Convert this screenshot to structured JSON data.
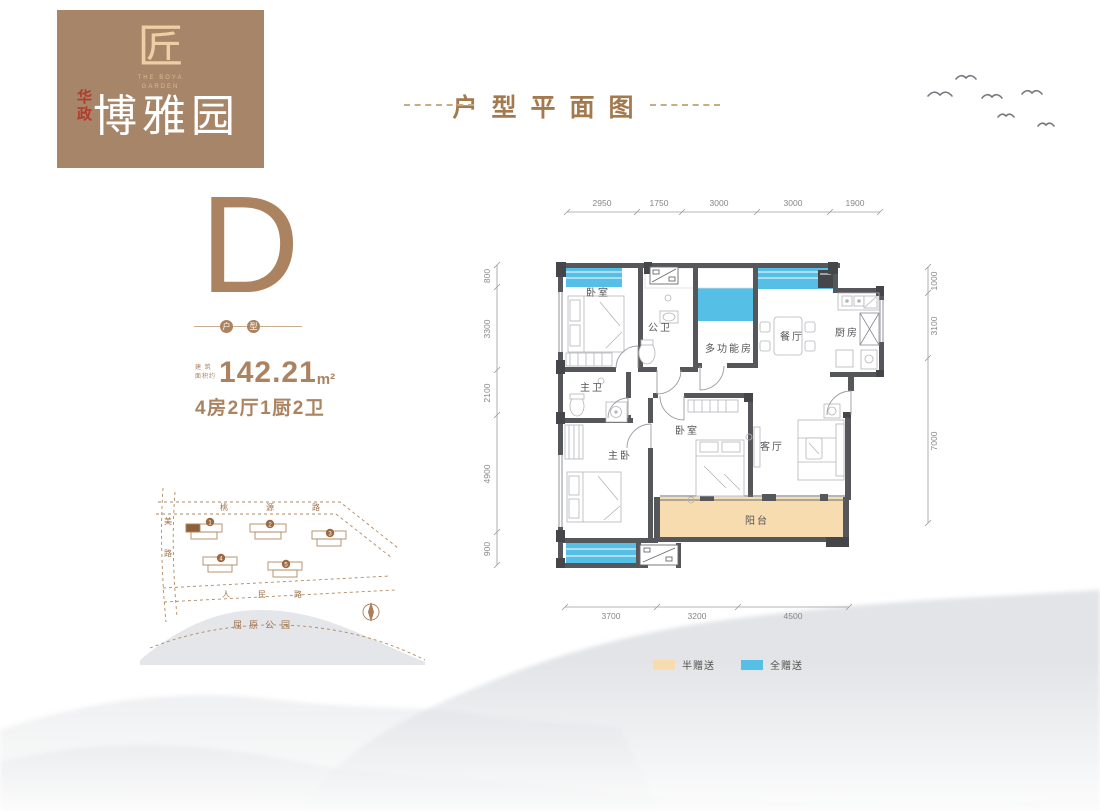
{
  "logo": {
    "seal_glyph": "匠",
    "brand_en_line1": "THE BOYA",
    "brand_en_line2": "GARDEN",
    "brand_prefix": "华政",
    "brand_name": "博雅园"
  },
  "header": {
    "title": "户型平面图"
  },
  "unit": {
    "letter": "D",
    "badge_left": "户",
    "badge_right": "型",
    "area_prefix_top": "建 筑",
    "area_prefix_bottom": "面积约",
    "area_value": "142.21",
    "area_unit": "m²",
    "layout": "4房2厅1厨2卫"
  },
  "floorplan": {
    "rooms": {
      "bedroom_tl": "卧室",
      "public_bath": "公卫",
      "multi_room": "多功能房",
      "dining": "餐厅",
      "kitchen": "厨房",
      "master_bath": "主卫",
      "master_bedroom": "主卧",
      "bedroom_mid": "卧室",
      "living": "客厅",
      "balcony": "阳台"
    },
    "dim_top": [
      "2950",
      "1750",
      "3000",
      "3000",
      "1900"
    ],
    "dim_left": [
      "800",
      "3300",
      "2100",
      "4900",
      "900"
    ],
    "dim_right": [
      "1000",
      "3100",
      "7000"
    ],
    "dim_bottom": [
      "3700",
      "3200",
      "4500"
    ]
  },
  "legend": {
    "half_gift": {
      "label": "半赠送",
      "color": "#f6dcae"
    },
    "full_gift": {
      "label": "全赠送",
      "color": "#55bfe5"
    }
  },
  "siteplan": {
    "road_top": "桃源路",
    "road_left": [
      "美",
      "路"
    ],
    "road_bottom": "人民路",
    "park": "屈原公园",
    "building_numbers": [
      "1",
      "2",
      "3",
      "4",
      "5"
    ]
  },
  "colors": {
    "accent_brown": "#ab8361",
    "logo_bg": "#a78568",
    "full_gift_blue": "#55bfe5",
    "half_gift_tan": "#f6dcae",
    "wall_gray": "#56575b"
  }
}
